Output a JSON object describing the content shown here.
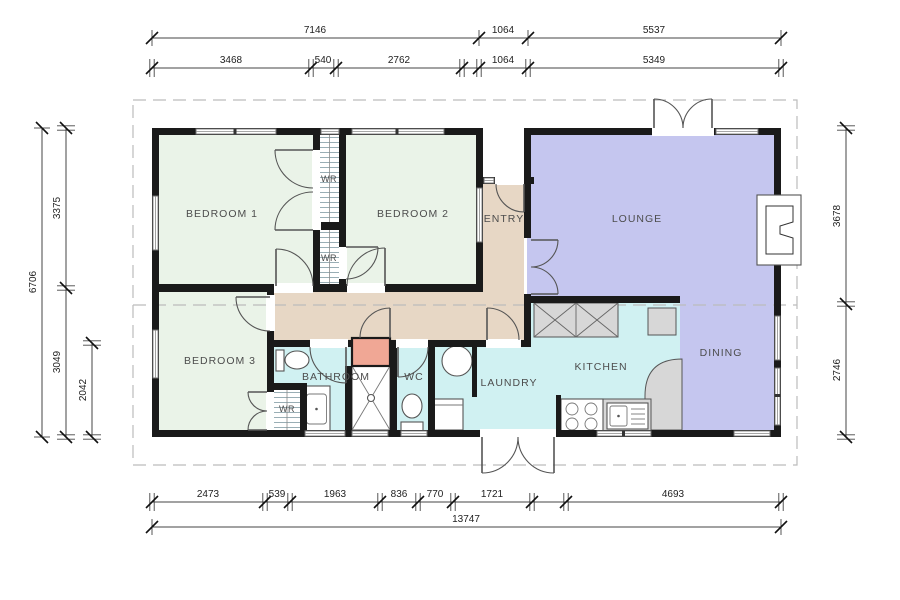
{
  "plan": {
    "rooms": {
      "bedroom1": "BEDROOM 1",
      "bedroom2": "BEDROOM 2",
      "bedroom3": "BEDROOM 3",
      "entry": "ENTRY",
      "lounge": "LOUNGE",
      "dining": "DINING",
      "kitchen": "KITCHEN",
      "laundry": "LAUNDRY",
      "bathroom": "BATHROOM",
      "wc": "WC",
      "wr": "WR"
    },
    "colors": {
      "bedroom": "#eaf3e8",
      "living": "#c5c6ef",
      "wet": "#d0f1f2",
      "hall": "#e7d7c5",
      "cupboard": "#f0a795",
      "bench": "#d7d7d7",
      "wall": "#1a1a1a"
    },
    "dimensions": {
      "top_outer": [
        "7146",
        "1064",
        "5537"
      ],
      "top_inner": [
        "3468",
        "540",
        "2762",
        "1064",
        "5349"
      ],
      "bottom_inner": [
        "2473",
        "539",
        "1963",
        "836",
        "770",
        "1721",
        "4693"
      ],
      "bottom_total": "13747",
      "left_outer": "6706",
      "left_top": "3375",
      "left_bottom": "3049",
      "left_inner": "2042",
      "right_top": "3678",
      "right_bottom": "2746"
    }
  }
}
